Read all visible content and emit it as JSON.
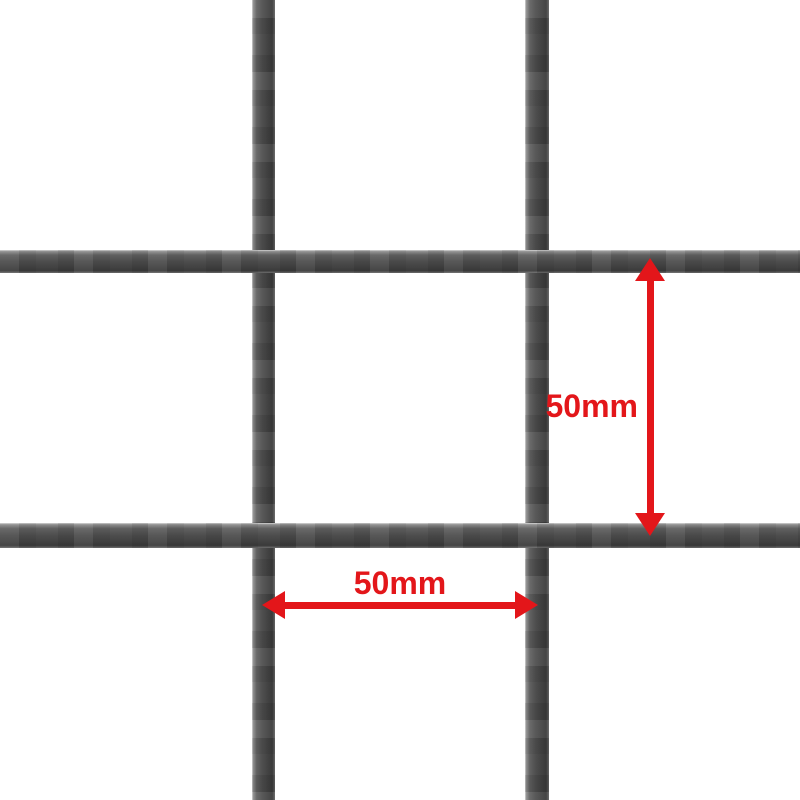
{
  "scene": {
    "background_color": "#ffffff",
    "description": "wire mesh grid with red dimension annotations"
  },
  "mesh": {
    "wire_color_mid": "#4a4a4a",
    "wire_color_dark": "#3a3a3a",
    "wire_color_highlight": "#d9d9d9",
    "vertical_wire_count": 2,
    "horizontal_wire_count": 2
  },
  "annotations": {
    "accent_color": "#e3161a",
    "vertical_dimension": {
      "label": "50mm"
    },
    "horizontal_dimension": {
      "label": "50mm"
    }
  }
}
